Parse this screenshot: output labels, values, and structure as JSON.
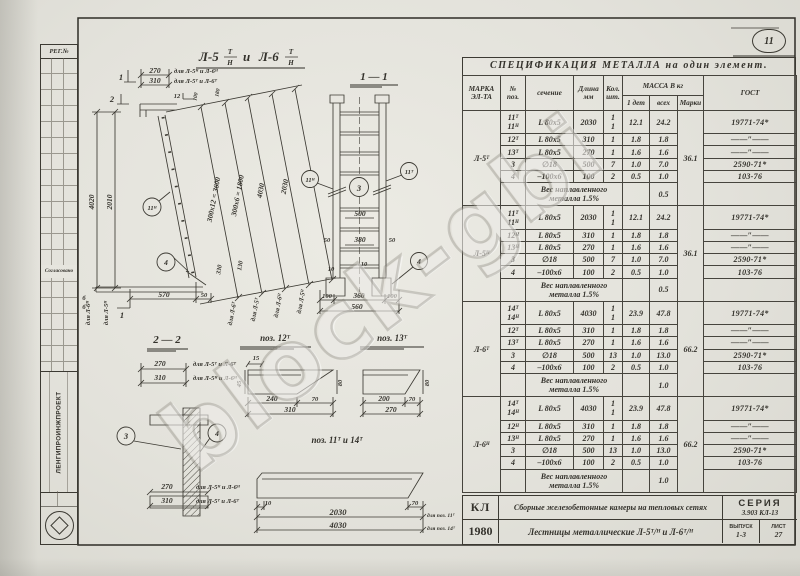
{
  "watermark": "block-gbi",
  "corner_mark": "11",
  "stamp": {
    "reg": "РЕГ.№",
    "org": "ЛЕНГИПРОИНЖПРОЕКТ",
    "agreed": "Согласовано"
  },
  "drawing": {
    "title": {
      "b1": "Л-5",
      "s1": "Т",
      "n1": "Н",
      "conj": "и",
      "b2": "Л-6",
      "s2": "Т",
      "n2": "Н"
    },
    "labels": {
      "t270": "270",
      "t270n": "для Л-5ᴴ и Л-6ᴴ",
      "t310": "310",
      "t310n": "для Л-5ᵀ и Л-6ᵀ",
      "cut1": "1",
      "cut2": "2",
      "c12": "12",
      "t100": "100",
      "t180": "180",
      "v4020": "4020",
      "v2010": "2010",
      "v4020n": "для Л-6ᴴ",
      "v2010n": "для Л-5ᴴ",
      "d3600": "300х12 = 3600",
      "d1800": "300х6 = 1800",
      "d4030": "4030",
      "d2030": "2030",
      "dn1": "для Л-6ᵀ",
      "dn2": "для Л-5ᵀ",
      "dn3": "для Л-6ᴴ",
      "dn4": "для Л-5ᴴ",
      "t330": "330",
      "t130": "130",
      "t570": "570",
      "t50": "50",
      "b": "б",
      "s11": "1 — 1",
      "s22": "2 — 2",
      "r500": "500",
      "r380": "380",
      "r50": "50",
      "r10": "10",
      "b100": "100",
      "b360": "360",
      "b560": "560",
      "c11n": "11ᴴ",
      "c11t": "11ᵀ",
      "c3": "3",
      "c4": "4",
      "s270": "270",
      "s270n": "для Л-5ᵀ и Л-6ᵀ",
      "s310": "310",
      "s310n": "для Л-5ᴴ и Л-6ᴴ",
      "b270": "270",
      "b270n": "для Л-5ᴴ и Л-6ᴴ",
      "b310": "310",
      "b310n": "для Л-5ᵀ и Л-6ᵀ",
      "p12": "поз. 12ᵀ",
      "p13": "поз. 13ᵀ",
      "p1114": "поз. 11ᵀ и 14ᵀ",
      "d15": "15",
      "d45": "45",
      "d80": "80",
      "d240": "240",
      "d70": "70",
      "d310": "310",
      "e200": "200",
      "e70": "70",
      "e270": "270",
      "e80": "80",
      "lp10": "10",
      "lp70": "70",
      "lp2030": "2030",
      "lp4030": "4030",
      "lpn11": "для поз. 11ᵀ",
      "lpn14": "для поз. 14ᵀ"
    }
  },
  "spec": {
    "title": "СПЕЦИФИКАЦИЯ  МЕТАЛЛА  на  один  элемент.",
    "headers": {
      "mark": "МАРКА\nЭЛ-ТА",
      "poz": "№\nпоз.",
      "sec": "сечение",
      "len": "Длина\nмм",
      "qty": "Кол.\nшт.",
      "mass": "МАССА В кг",
      "m1": "1 дет",
      "mall": "всех",
      "marki": "Марки",
      "gost": "ГОСТ"
    },
    "weld_note": "Вес наплавленного\nметалла  1.5%",
    "groups": [
      {
        "mark": "Л-5ᵀ",
        "marki": "36.1",
        "weld_val": "0.5",
        "rows": [
          {
            "poz": "11ᵀ\n11ᴴ",
            "sec": "L 80х5",
            "len": "2030",
            "qty": "1\n1",
            "m1": "12.1",
            "mall": "24.2",
            "gost": "19771-74*"
          },
          {
            "poz": "12ᵀ",
            "sec": "L 80х5",
            "len": "310",
            "qty": "1",
            "m1": "1.8",
            "mall": "1.8",
            "gost": "——″——"
          },
          {
            "poz": "13ᵀ",
            "sec": "L 80х5",
            "len": "270",
            "qty": "1",
            "m1": "1.6",
            "mall": "1.6",
            "gost": "——″——"
          },
          {
            "poz": "3",
            "sec": "∅18",
            "len": "500",
            "qty": "7",
            "m1": "1.0",
            "mall": "7.0",
            "gost": "2590-71*"
          },
          {
            "poz": "4",
            "sec": "–100х6",
            "len": "100",
            "qty": "2",
            "m1": "0.5",
            "mall": "1.0",
            "gost": "103-76"
          }
        ]
      },
      {
        "mark": "Л-5ᴴ",
        "marki": "36.1",
        "weld_val": "0.5",
        "rows": [
          {
            "poz": "11ᵀ\n11ᴴ",
            "sec": "L 80х5",
            "len": "2030",
            "qty": "1\n1",
            "m1": "12.1",
            "mall": "24.2",
            "gost": "19771-74*"
          },
          {
            "poz": "12ᴴ",
            "sec": "L 80х5",
            "len": "310",
            "qty": "1",
            "m1": "1.8",
            "mall": "1.8",
            "gost": "——″——"
          },
          {
            "poz": "13ᴴ",
            "sec": "L 80х5",
            "len": "270",
            "qty": "1",
            "m1": "1.6",
            "mall": "1.6",
            "gost": "——″——"
          },
          {
            "poz": "3",
            "sec": "∅18",
            "len": "500",
            "qty": "7",
            "m1": "1.0",
            "mall": "7.0",
            "gost": "2590-71*"
          },
          {
            "poz": "4",
            "sec": "–100х6",
            "len": "100",
            "qty": "2",
            "m1": "0.5",
            "mall": "1.0",
            "gost": "103-76"
          }
        ]
      },
      {
        "mark": "Л-6ᵀ",
        "marki": "66.2",
        "weld_val": "1.0",
        "rows": [
          {
            "poz": "14ᵀ\n14ᴴ",
            "sec": "L 80х5",
            "len": "4030",
            "qty": "1\n1",
            "m1": "23.9",
            "mall": "47.8",
            "gost": "19771-74*"
          },
          {
            "poz": "12ᵀ",
            "sec": "L 80х5",
            "len": "310",
            "qty": "1",
            "m1": "1.8",
            "mall": "1.8",
            "gost": "——″——"
          },
          {
            "poz": "13ᵀ",
            "sec": "L 80х5",
            "len": "270",
            "qty": "1",
            "m1": "1.6",
            "mall": "1.6",
            "gost": "——″——"
          },
          {
            "poz": "3",
            "sec": "∅18",
            "len": "500",
            "qty": "13",
            "m1": "1.0",
            "mall": "13.0",
            "gost": "2590-71*"
          },
          {
            "poz": "4",
            "sec": "–100х6",
            "len": "100",
            "qty": "2",
            "m1": "0.5",
            "mall": "1.0",
            "gost": "103-76"
          }
        ]
      },
      {
        "mark": "Л-6ᴴ",
        "marki": "66.2",
        "weld_val": "1.0",
        "rows": [
          {
            "poz": "14ᵀ\n14ᴴ",
            "sec": "L 80х5",
            "len": "4030",
            "qty": "1\n1",
            "m1": "23.9",
            "mall": "47.8",
            "gost": "19771-74*"
          },
          {
            "poz": "12ᴴ",
            "sec": "L 80х5",
            "len": "310",
            "qty": "1",
            "m1": "1.8",
            "mall": "1.8",
            "gost": "——″——"
          },
          {
            "poz": "13ᴴ",
            "sec": "L 80х5",
            "len": "270",
            "qty": "1",
            "m1": "1.6",
            "mall": "1.6",
            "gost": "——″——"
          },
          {
            "poz": "3",
            "sec": "∅18",
            "len": "500",
            "qty": "13",
            "m1": "1.0",
            "mall": "13.0",
            "gost": "2590-71*"
          },
          {
            "poz": "4",
            "sec": "–100х6",
            "len": "100",
            "qty": "2",
            "m1": "0.5",
            "mall": "1.0",
            "gost": "103-76"
          }
        ]
      }
    ]
  },
  "title_block": {
    "logo": "КЛ",
    "year": "1980",
    "line1": "Сборные железобетонные камеры на тепловых сетях",
    "line2": "Лестницы металлические  Л-5ᵀ/ᴴ и Л-6ᵀ/ᴴ",
    "series_label": "СЕРИЯ",
    "series": "3.903 КЛ-13",
    "issue_label": "ВЫПУСК",
    "issue": "1-3",
    "sheet_label": "ЛИСТ",
    "sheet": "27"
  }
}
